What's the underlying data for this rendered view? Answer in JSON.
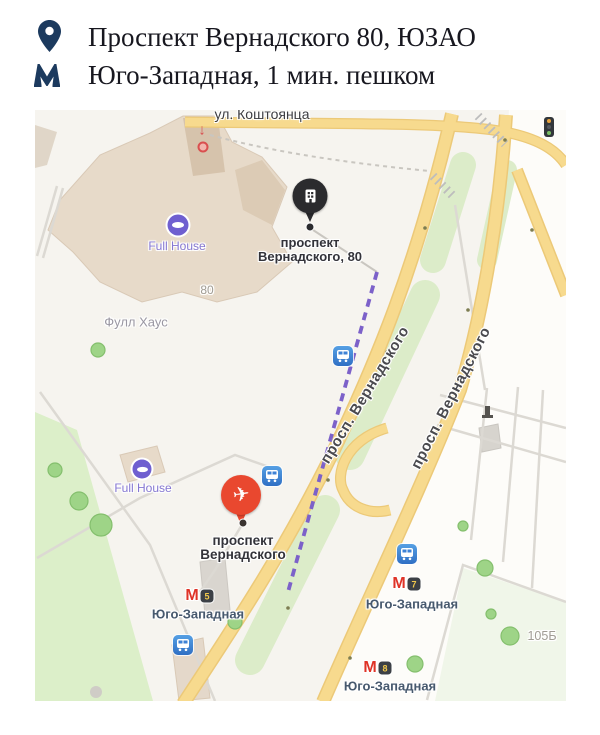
{
  "header": {
    "address_line": "Проспект Вернадского 80,  ЮЗАО",
    "metro_line": "Юго-Западная, 1 мин. пешком"
  },
  "map": {
    "streets": {
      "koshtoyantsa": "ул. Коштоянца",
      "vernadskogo_west": "просп. Вернадского",
      "vernadskogo_east": "просп. Вернадского"
    },
    "destination_marker": {
      "line1": "проспект",
      "line2": "Вернадского, 80"
    },
    "metro_marker": {
      "line1": "проспект",
      "line2": "Вернадского"
    },
    "pois": {
      "full_house_1": "Full House",
      "full_house_2": "Full House",
      "full_house_ru": "Фулл Хаус"
    },
    "house_numbers": {
      "building_80": "80",
      "building_105b": "105Б"
    },
    "metro_labels": [
      {
        "name": "Юго-Западная",
        "exit": "5"
      },
      {
        "name": "Юго-Западная",
        "exit": "7"
      },
      {
        "name": "Юго-Западная",
        "exit": "8"
      }
    ],
    "colors": {
      "road_fill": "#f7da8e",
      "route_line": "#7c61c9",
      "destination_pin": "#2b2b2e",
      "metro_pin": "#e9482f",
      "metro_m": "#df3327",
      "park_green": "#dcefc9",
      "accent_navy": "#1c3a5e"
    }
  }
}
